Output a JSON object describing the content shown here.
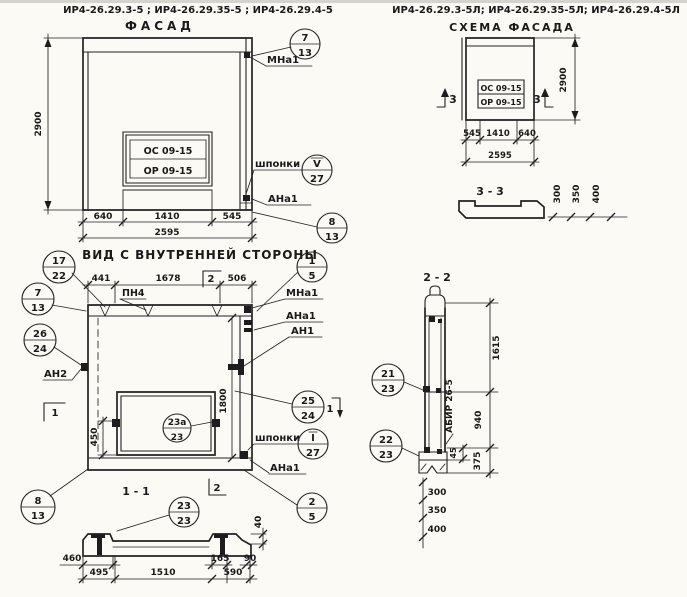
{
  "titles": {
    "series_left": "ИР4-26.29.3-5 ; ИР4-26.29.35-5 ; ИР4-26.29.4-5",
    "series_right": "ИР4-26.29.3-5Л; ИР4-26.29.35-5Л; ИР4-26.29.4-5Л",
    "facade": "ФАСАД",
    "scheme": "СХЕМА ФАСАДА",
    "inner": "ВИД С ВНУТРЕННЕЙ СТОРОНЫ",
    "s11": "1 - 1",
    "s22": "2 - 2",
    "s33": "3 - 3"
  },
  "labels": {
    "mna1": "МНа1",
    "ana1": "АНа1",
    "an1": "АН1",
    "an2": "АН2",
    "pn4": "ПН4",
    "shponki": "шпонки",
    "abir": "АБИР 26-5",
    "os": "ОС 09-15",
    "orr": "ОР 09-15"
  },
  "marks": {
    "m1": "1",
    "m2": "2",
    "m3": "3"
  },
  "balloons": {
    "fac_top": {
      "top": "7",
      "bottom": "13"
    },
    "fac_key": {
      "top": "V",
      "bottom": "27"
    },
    "fac_bot": {
      "top": "8",
      "bottom": "13"
    },
    "inn_17_22": {
      "top": "17",
      "bottom": "22"
    },
    "inn_7_13": {
      "top": "7",
      "bottom": "13"
    },
    "inn_26_24": {
      "top": "26",
      "bottom": "24"
    },
    "inn_8_13": {
      "top": "8",
      "bottom": "13"
    },
    "inn_1_5": {
      "top": "1",
      "bottom": "5"
    },
    "inn_25_24": {
      "top": "25",
      "bottom": "24"
    },
    "inn_key": {
      "top": "I",
      "bottom": "27"
    },
    "inn_2_5": {
      "top": "2",
      "bottom": "5"
    },
    "opening": {
      "top": "23а",
      "bottom": "23"
    },
    "s11": {
      "top": "23",
      "bottom": "23"
    },
    "s22_21": {
      "top": "21",
      "bottom": "23"
    },
    "s22_22": {
      "top": "22",
      "bottom": "23"
    }
  },
  "dims": {
    "facade": {
      "height": "2900",
      "w1": "640",
      "w2": "1410",
      "w3": "545",
      "total": "2595"
    },
    "scheme": {
      "height": "2900",
      "w1": "545",
      "w2": "1410",
      "w3": "640",
      "total": "2595"
    },
    "s33": {
      "d1": "300",
      "d2": "350",
      "d3": "400"
    },
    "inner": {
      "w1": "441",
      "w2": "1678",
      "w3": "506",
      "open": "450",
      "height": "1800"
    },
    "s11": {
      "a": "460",
      "b": "495",
      "c": "1510",
      "d": "165",
      "e": "590",
      "f": "90",
      "g": "40"
    },
    "s22": {
      "a": "1615",
      "b": "940",
      "c": "45",
      "d": "375",
      "l1": "300",
      "l2": "350",
      "l3": "400"
    }
  }
}
